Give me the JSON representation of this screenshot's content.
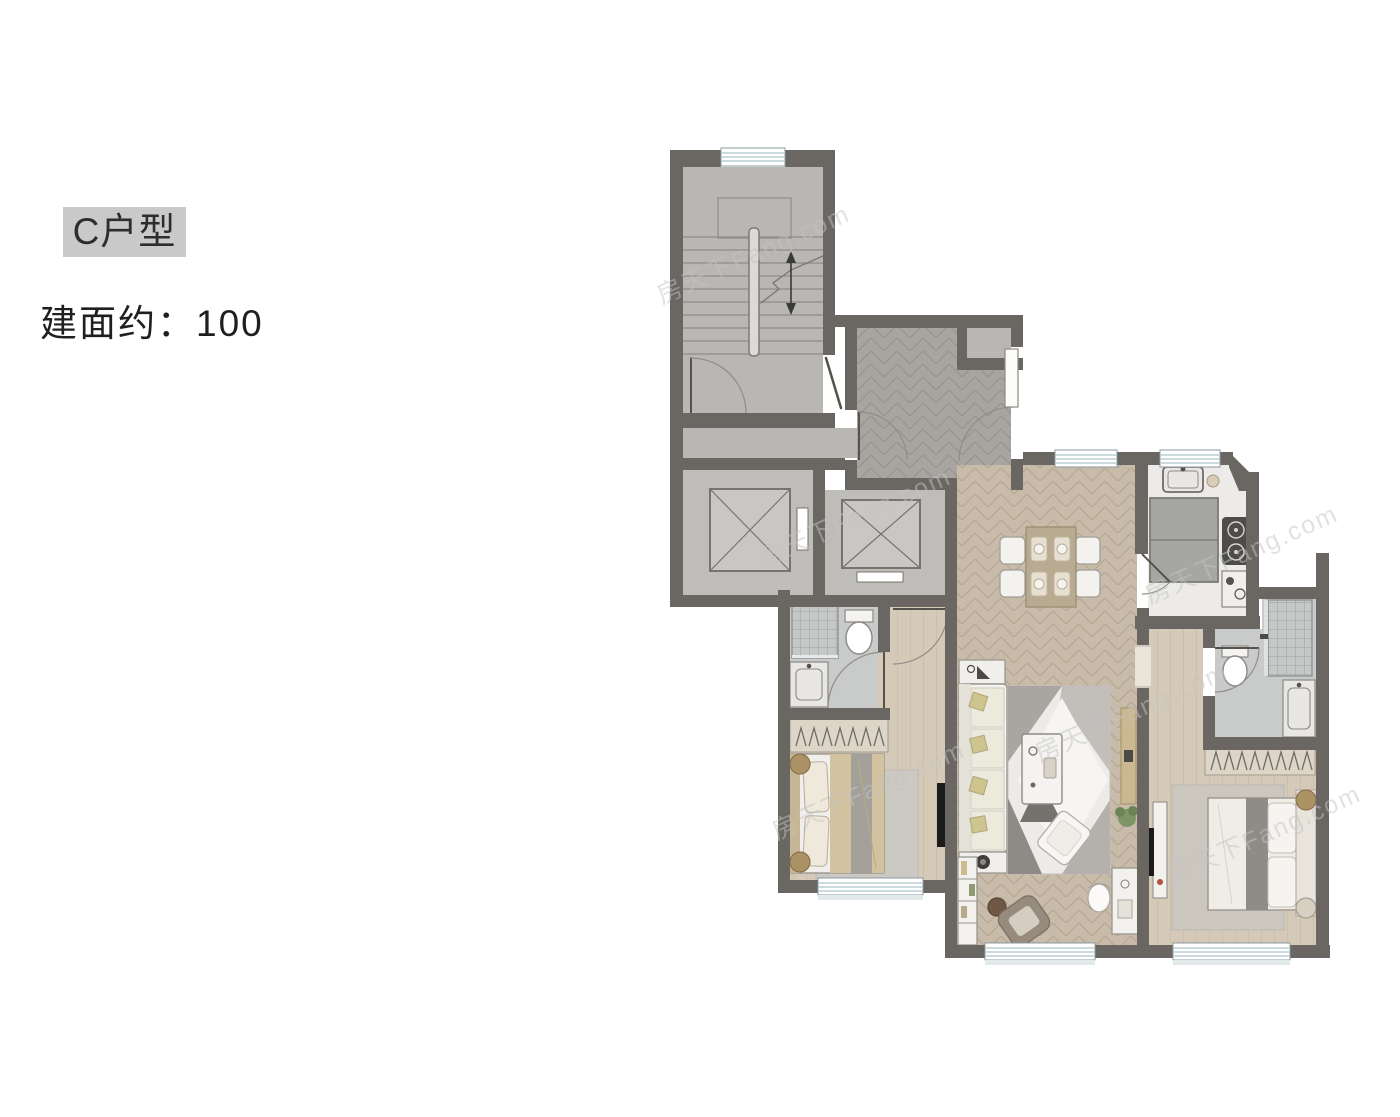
{
  "labels": {
    "unit_type": "C户型",
    "area": "建面约：100"
  },
  "watermark": {
    "text": "房天下Fang.com"
  },
  "colors": {
    "badge_bg": "#c9c9c9",
    "wall": "#6a6661",
    "core_floor": "#b9b7b3",
    "hall_tile": "#a8a5a1",
    "wood_floor": "#c8bbaa",
    "plank_floor": "#d5cab7",
    "bath_floor": "#c9cbcb",
    "kitchen_floor": "#ecebe9",
    "window_line": "#b9cdd3",
    "furniture_white": "#f2f1ee",
    "furniture_wood": "#b9ab91",
    "tv_black": "#1b1b1b",
    "plant_green": "#7d9464"
  }
}
